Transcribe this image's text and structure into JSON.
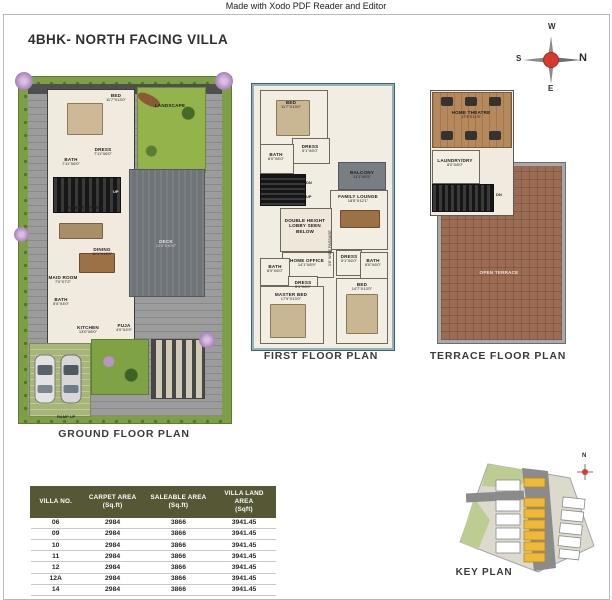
{
  "watermark": "Made with Xodo PDF Reader and Editor",
  "title": "4BHK- NORTH FACING VILLA",
  "compass": {
    "top": "W",
    "right": "N",
    "bottom": "E",
    "left": "S"
  },
  "colors": {
    "compass_red": "#d63a2f",
    "table_header_bg": "#565735",
    "keyplan_highlight": "#f0b83a",
    "landscape_green": "#7d9f45",
    "deck_gray": "#6f7479",
    "terrace_brick": "#9b6b52"
  },
  "plans": {
    "ground": {
      "caption": "GROUND FLOOR PLAN",
      "rooms": {
        "bed": {
          "name": "BED",
          "dim": "11'7\"X13'0\""
        },
        "dress": {
          "name": "DRESS",
          "dim": "7'11\"X6'0\""
        },
        "bath": {
          "name": "BATH",
          "dim": "7'11\"X6'0\""
        },
        "up": {
          "name": "UP"
        },
        "family_living": {
          "name": "FAMILY LIVING",
          "dim": "11'7\"X13'2\""
        },
        "dining": {
          "name": "DINING",
          "dim": "11'1\"X13'9\""
        },
        "maid_room": {
          "name": "MAID ROOM",
          "dim": "7'0\"X7'2\""
        },
        "bath2": {
          "name": "BATH",
          "dim": "5'0\"X4'0\""
        },
        "kitchen": {
          "name": "KITCHEN",
          "dim": "13'0\"X8'0\""
        },
        "puja": {
          "name": "PUJA",
          "dim": "4'0\"X4'9\""
        },
        "deck": {
          "name": "DECK",
          "dim": "12'0\"X40'0\""
        },
        "landscape": {
          "name": "LANDSCAPE"
        },
        "ramp": {
          "name": "RAMP UP"
        }
      }
    },
    "first": {
      "caption": "FIRST FLOOR PLAN",
      "rooms": {
        "bed1": {
          "name": "BED",
          "dim": "11'7\"X13'0\""
        },
        "dress1": {
          "name": "DRESS",
          "dim": "5'1\"X6'0\""
        },
        "bath1": {
          "name": "BATH",
          "dim": "8'0\"X6'0\""
        },
        "balcony": {
          "name": "BALCONY",
          "dim": "11'1\"X5'5\""
        },
        "family_lounge": {
          "name": "FAMILY LOUNGE",
          "dim": "18'5\"X12'1\""
        },
        "lobby": {
          "name": "DOUBLE HEIGHT",
          "name2": "LOBBY SEEN",
          "name3": "BELOW"
        },
        "home_office": {
          "name": "HOME OFFICE",
          "dim": "14'1\"X8'9\""
        },
        "passage": {
          "name": "3'6\" WIDE PASSAGE"
        },
        "bath2": {
          "name": "BATH",
          "dim": "8'0\"X6'0\""
        },
        "dress2": {
          "name": "DRESS",
          "dim": "5'1\"X6'0\""
        },
        "bath3": {
          "name": "BATH",
          "dim": "8'0\"X6'0\""
        },
        "dress3": {
          "name": "DRESS",
          "dim": "5'1\"X6'0\""
        },
        "master_bed": {
          "name": "MASTER BED",
          "dim": "17'9\"X13'0\""
        },
        "bed2": {
          "name": "BED",
          "dim": "14'7\"X13'0\""
        },
        "dn": {
          "name": "DN"
        },
        "up": {
          "name": "UP"
        }
      }
    },
    "terrace": {
      "caption": "TERRACE FLOOR PLAN",
      "rooms": {
        "home_theatre": {
          "name": "HOME THEATRE",
          "dim": "17'3\"X11'9\""
        },
        "laundry": {
          "name": "LAUNDRY/DRY",
          "dim": "8'0\"X8'0\""
        },
        "dn": {
          "name": "DN"
        },
        "open_terrace": {
          "name": "OPEN TERRACE"
        }
      }
    }
  },
  "table": {
    "headers": [
      {
        "line1": "VILLA NO.",
        "line2": ""
      },
      {
        "line1": "CARPET AREA",
        "line2": "(Sq.ft)"
      },
      {
        "line1": "SALEABLE AREA",
        "line2": "(Sq.ft)"
      },
      {
        "line1": "VILLA LAND AREA",
        "line2": "(Sqft)"
      }
    ],
    "rows": [
      [
        "06",
        "2984",
        "3866",
        "3941.45"
      ],
      [
        "09",
        "2984",
        "3866",
        "3941.45"
      ],
      [
        "10",
        "2984",
        "3866",
        "3941.45"
      ],
      [
        "11",
        "2984",
        "3866",
        "3941.45"
      ],
      [
        "12",
        "2984",
        "3866",
        "3941.45"
      ],
      [
        "12A",
        "2984",
        "3866",
        "3941.45"
      ],
      [
        "14",
        "2984",
        "3866",
        "3941.45"
      ]
    ]
  },
  "keyplan": {
    "caption": "KEY PLAN",
    "compass_label": "N"
  }
}
